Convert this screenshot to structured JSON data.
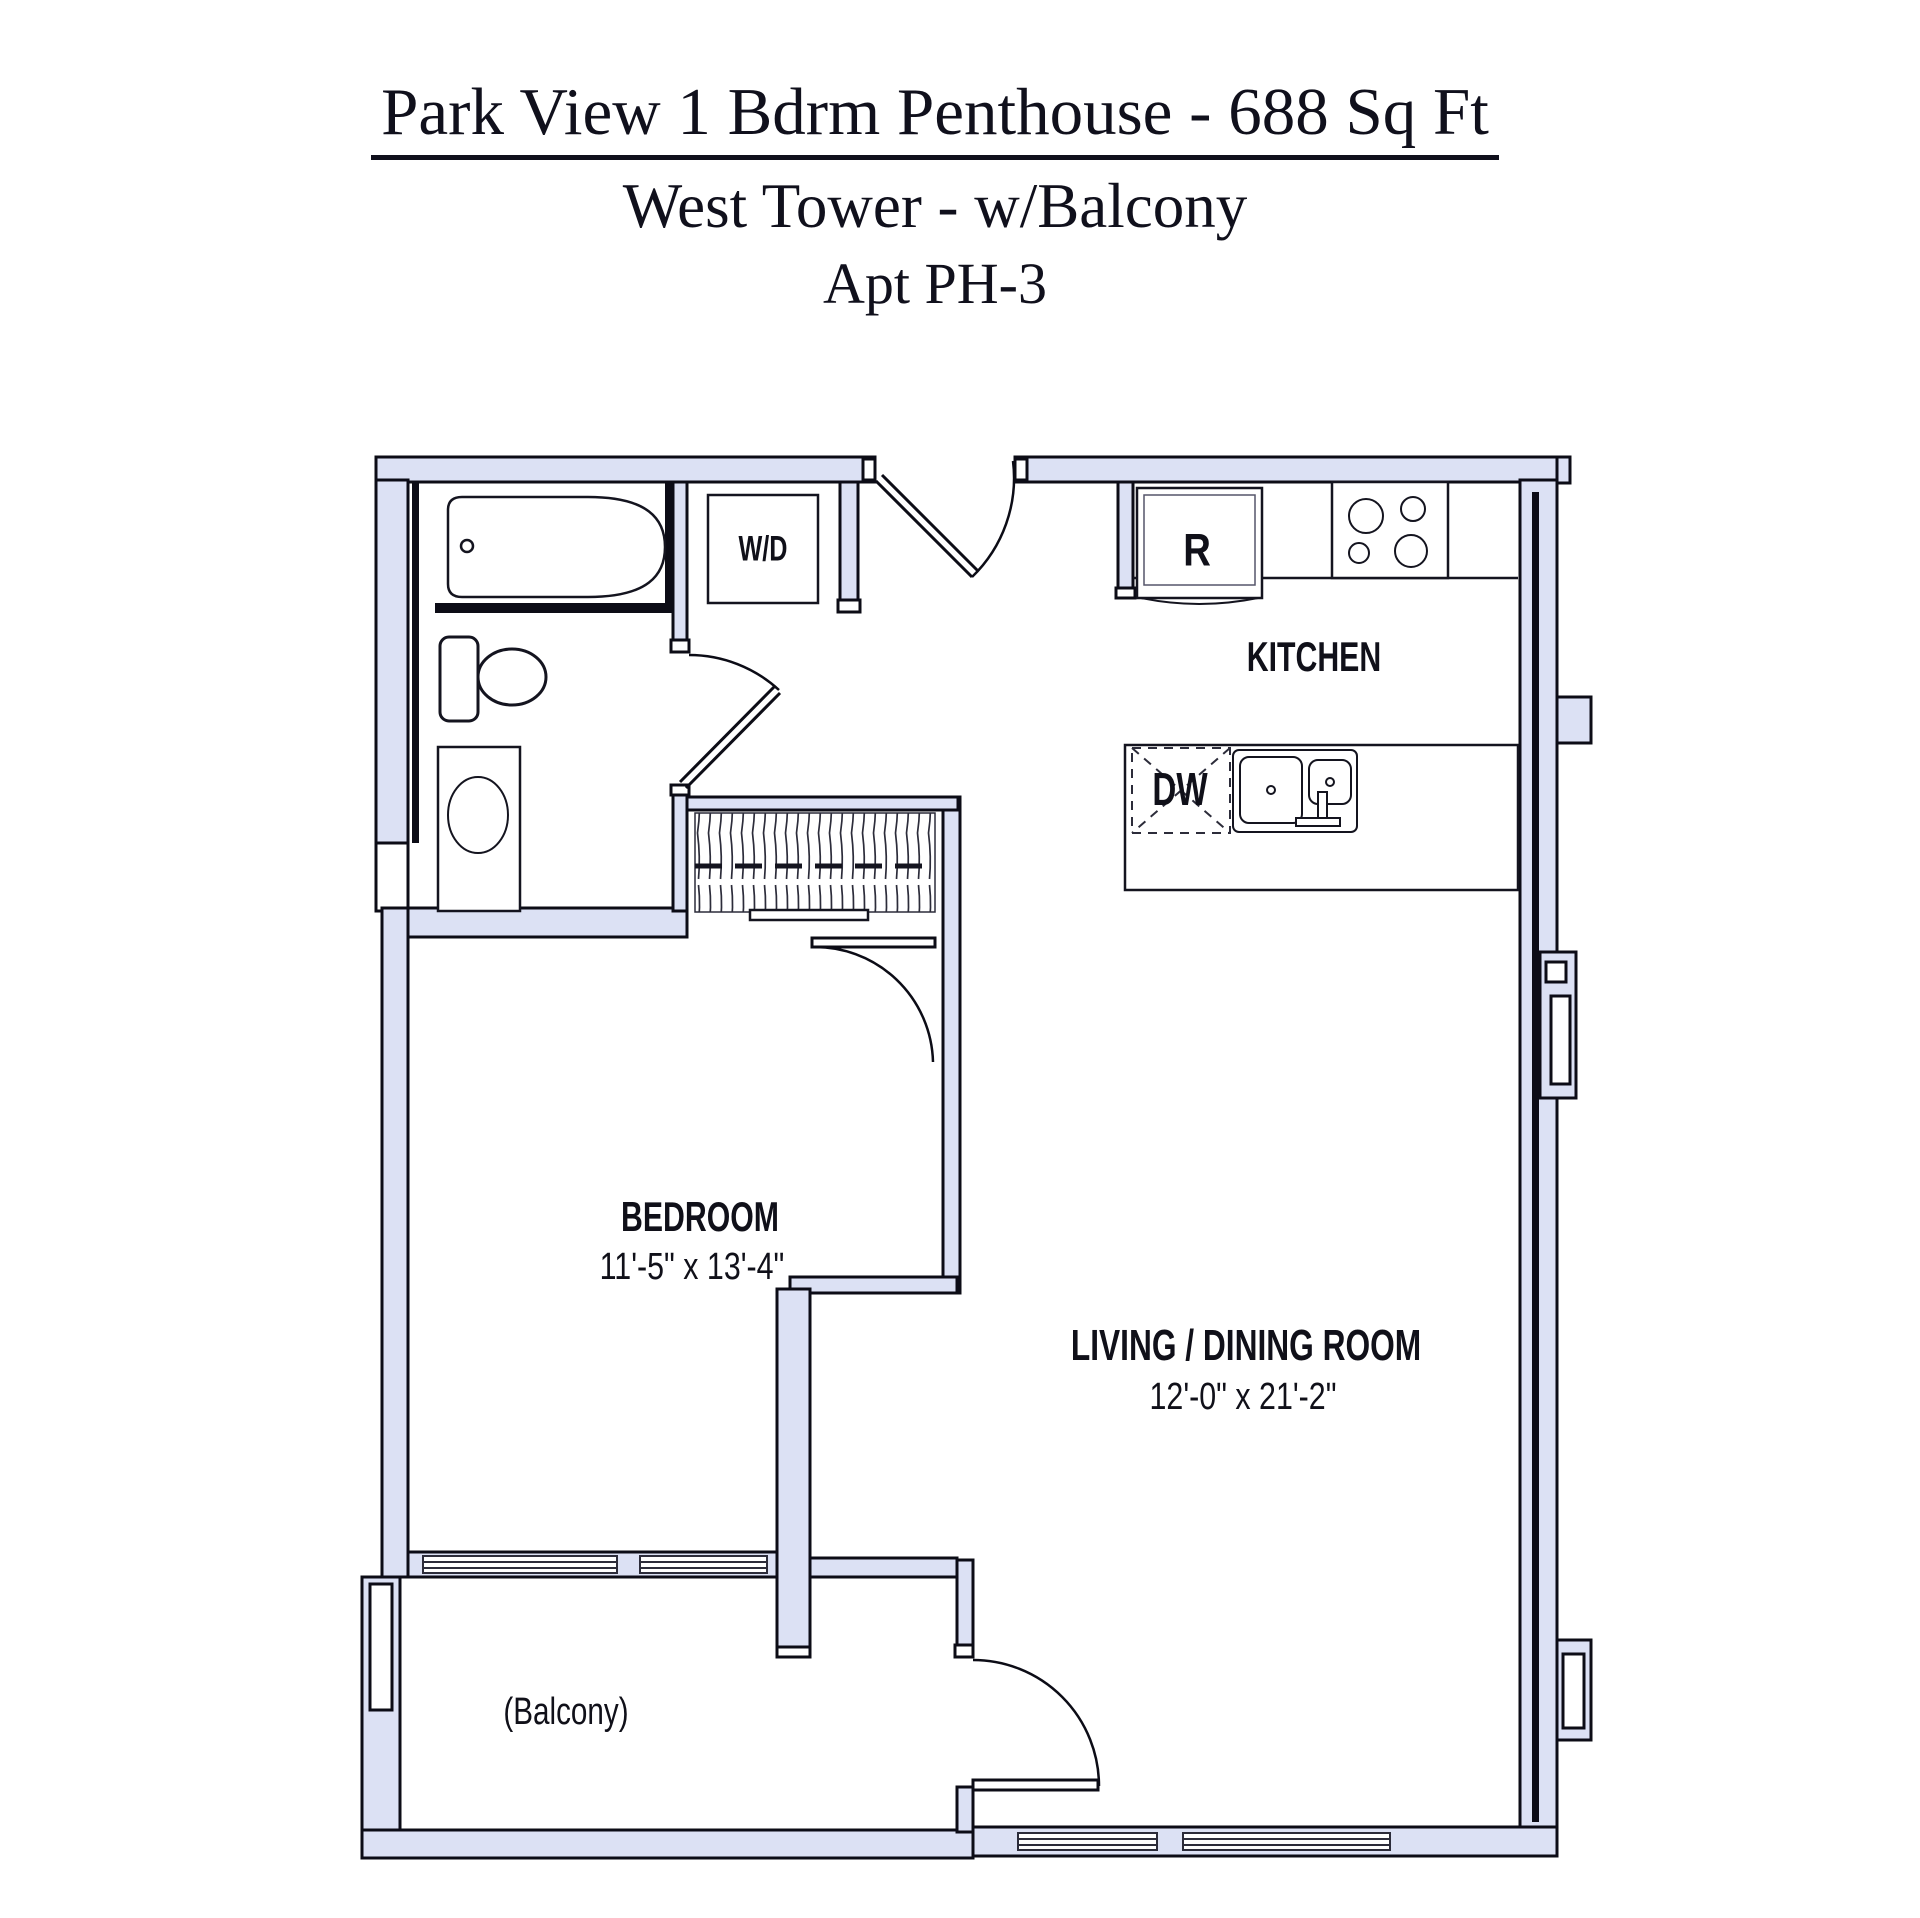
{
  "title": {
    "line1": "Park View 1 Bdrm Penthouse - 688 Sq Ft",
    "line2": "West Tower - w/Balcony",
    "line3": "Apt PH-3"
  },
  "rooms": {
    "bedroom": {
      "name": "BEDROOM",
      "dims": "11'-5\" x 13'-4\""
    },
    "living": {
      "name": "LIVING / DINING ROOM",
      "dims": "12'-0\" x 21'-2\""
    },
    "kitchen": {
      "name": "KITCHEN"
    },
    "balcony": {
      "name": "(Balcony)"
    }
  },
  "fixtures": {
    "washer_dryer": "W/D",
    "refrigerator": "R",
    "dishwasher": "DW"
  },
  "colors": {
    "wall_fill": "#dce1f4",
    "line": "#0c0c16",
    "text": "#14141f"
  }
}
